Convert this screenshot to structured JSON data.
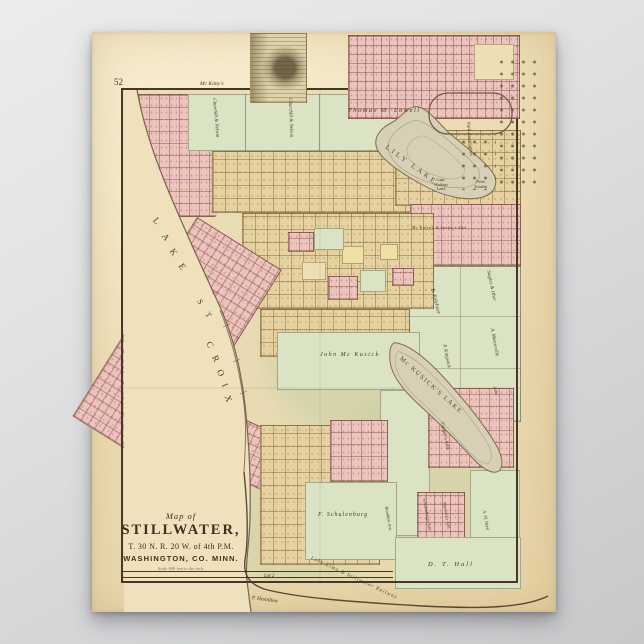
{
  "poster": {
    "page_number": "52",
    "title": {
      "prefix": "Map of",
      "name": "STILLWATER,",
      "township": "T. 30 N. R. 20 W. of 4th P.M.",
      "county": "WASHINGTON, CO. MINN.",
      "scale": "Scale 600 feet to the inch."
    },
    "lake_croix_letters": [
      "L",
      "A",
      "K",
      "E",
      "S",
      "T",
      "C",
      "R",
      "O",
      "I",
      "X"
    ],
    "labels": {
      "mckintys": "Mc Kinty's",
      "churchill_nelson_1": "Churchill & Nelson",
      "churchill_nelson_2": "Churchill & Nelson",
      "thomas_lowell": "Thomas M. Lowell",
      "lily_lake": "LILY LAKE",
      "park_association": "Park Association",
      "capt_watkins": "Capt.\nWatkins\nLand",
      "peter_tomlett": "Peter\nTomlett",
      "mckinstry": "Mc Kinstry & Seeley's Add.",
      "kelchner": "B. Kelchner",
      "staples_ober": "Staples & Ober",
      "masterville": "A. Masterville",
      "kingwick": "P. Kingwick",
      "john_mckusick": "John Mc Kusick",
      "mckusick_lake": "Mc KUSICK'S  LAKE",
      "john": "John",
      "coopers_add": "Cooper's Add.",
      "schulenburgs_add": "Schulenburg's Add.",
      "murdocks_add": "Murdock's Add.",
      "am_reed": "A. M. Reed",
      "dt_hall": "D. T. Hall",
      "f_schulenburg": "F. Schulenburg",
      "brooklyn_ave": "Brooklyn Ave.",
      "lot2": "Lot 2",
      "p_hamilton": "P. Hamilton",
      "railroad": "Lake Elmo & Stillwater Railway"
    },
    "colors": {
      "background_gray": "#d5d6d8",
      "paper_cream": "#ecddb4",
      "plat_pink": "#edc3be",
      "plat_tan": "#e6d2a0",
      "parcel_green": "#dbe3c5",
      "lake_fill": "#d8d0b6",
      "ink_brown": "#463726"
    }
  }
}
